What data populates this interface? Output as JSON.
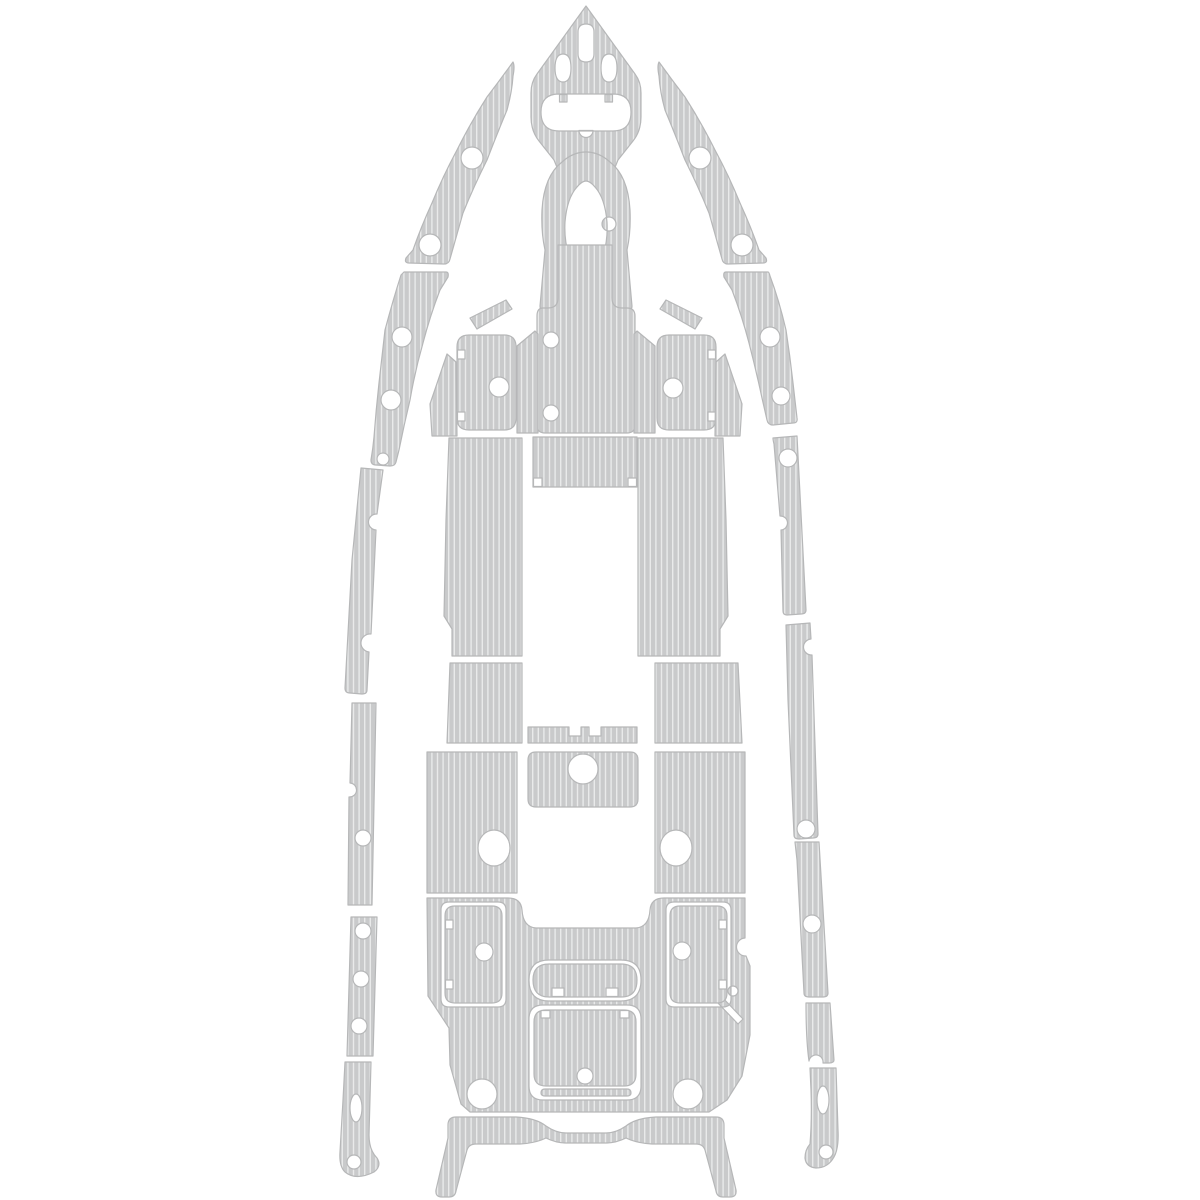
{
  "canvas": {
    "width": 1200,
    "height": 1200
  },
  "palette": {
    "background": "#ffffff",
    "pad_fill": "#c9cacb",
    "pad_stripe": "#e9eaea",
    "pad_outline": "#b6b7b8"
  },
  "pattern": {
    "orientation": "vertical",
    "stripe_pitch_px": 5.6,
    "stripe_width_px": 1.4
  },
  "pieces": [
    {
      "name": "bow-cap-pad",
      "d": "M586,6 L635,74 Q641,82 641,93 L641,117 Q641,131 633,141 L618,160 L611,177 Q598,168 586,168 Q574,168 561,177 L554,160 L539,141 Q531,131 531,117 L531,93 Q531,82 537,74 Z M586,24 Q594,24 594,32 L594,54 Q594,62 586,62 Q578,62 578,54 L578,32 Q578,24 586,24 Z M563,54 Q571,54 571,68 Q571,82 563,82 Q555,82 555,68 Q555,54 563,54 Z M609,54 Q617,54 617,68 Q617,82 609,82 Q601,82 601,68 Q601,54 609,54 Z M559,94 L613,94 Q631,94 631,112 Q631,131 613,131 L559,131 Q541,131 541,112 Q541,94 559,94 Z M559.5,94.5 L567,94.5 L567,102 L559.5,102 Z M605,94.5 L612.5,94.5 L612.5,102 L605,102 Z M579,130.5 A7,7 0 0 0 593,130.5 Z"
    },
    {
      "name": "bow-arch-pad",
      "d": "M540,306 L545,250 Q541,232 542,210 Q544,176 562,162 Q573,152 586,152 Q599,152 610,162 Q628,176 630,210 Q631,232 627,250 L632,306 Q632,311 626,311 L610,311 Q605,311 605,306 L603,256 Q608,240 607,222 Q605,198 595,187 Q590,181 586,181 Q582,181 577,187 Q567,198 565,222 Q564,240 569,256 L567,306 Q567,311 562,311 L546,311 Q540,311 540,306 Z M602,224 A7,7 0 1 0 616,224 A7,7 0 1 0 602,224 Z"
    },
    {
      "name": "console-front-pad",
      "d": "M558,245 L612,245 L612,298 Q612,308 622,308 L627,308 Q635,308 635,316 L635,425 Q635,433 627,433 L545,433 Q537,433 537,425 L537,316 Q537,308 543,308 L548,308 Q558,308 558,298 Z M543,340 A8,8 0 1 0 559,340 A8,8 0 1 0 543,340 Z M543,413 A8,8 0 1 0 559,413 A8,8 0 1 0 543,413 Z"
    },
    {
      "name": "fwd-hatch-pad-port",
      "d": "M469,335 L504,335 Q516,335 516,347 L516,418 Q516,430 504,430 L469,430 Q457,430 457,418 L457,347 Q457,335 469,335 Z M489,387 A10,10 0 1 0 509,387 A10,10 0 1 0 489,387 Z M457.5,350 L465,350 L465,359 L457.5,359 Z M457.5,412 L465,412 L465,421 L457.5,421 Z"
    },
    {
      "name": "fwd-hatch-pad-starboard",
      "d": "M669,335 L704,335 Q716,335 716,347 L716,418 Q716,430 704,430 L669,430 Q657,430 657,418 L657,347 Q657,335 669,335 Z M663,388 A10,10 0 1 0 683,388 A10,10 0 1 0 663,388 Z M708,350 L715.5,350 L715.5,359 L708,359 Z M708,412 L715.5,412 L715.5,421 L708,421 Z"
    },
    {
      "name": "fwd-floor-strip-port",
      "d": "M517,346 L535,331 L538,334 L538,433 L517,433 Z"
    },
    {
      "name": "fwd-floor-strip-starboard",
      "d": "M655,346 L637,331 L634,334 L634,433 L655,433 Z"
    },
    {
      "name": "bow-sliver-port",
      "d": "M470,318 L506,300 L512,309 L477,329 Z"
    },
    {
      "name": "bow-sliver-starboard",
      "d": "M702,318 L666,300 L660,309 L695,329 Z"
    },
    {
      "name": "bow-wedge-port",
      "d": "M432,436 L430,404 L447,354 L456,362 L457,436 Z"
    },
    {
      "name": "bow-wedge-starboard",
      "d": "M740,436 L742,404 L725,354 L716,362 L715,436 Z"
    },
    {
      "name": "cockpit-floor-port",
      "d": "M449,438 L522,438 L522,656 L452,656 L452,629 L444,616 L446,520 Z"
    },
    {
      "name": "cockpit-floor-starboard",
      "d": "M638,438 L723,438 L726,520 L728,616 L720,629 L720,656 L638,656 Z"
    },
    {
      "name": "cockpit-floor-center",
      "d": "M533,437 L637,437 L637,487 L533,487 Z M533.5,478 L542,478 L542,486.5 L533.5,486.5 Z M628,478 L636.5,478 L636.5,486.5 L628,486.5 Z"
    },
    {
      "name": "mid-floor-port",
      "d": "M450,663 L522,663 L522,743 L447,743 Z"
    },
    {
      "name": "mid-floor-starboard",
      "d": "M655,663 L738,663 L742,743 L655,743 Z"
    },
    {
      "name": "step-pad",
      "d": "M528,727 L569,727 L569,736 L581,736 L581,727 L589,727 L589,736 L601,736 L601,727 L637,727 L637,743 L528,743 Z"
    },
    {
      "name": "leaning-post-pad",
      "d": "M536,752 L630,752 Q638,752 638,760 L638,799 Q638,807 630,807 L536,807 Q528,807 528,799 L528,760 Q528,752 536,752 Z M568,769 A15,15 0 1 0 598,769 A15,15 0 1 0 568,769 Z"
    },
    {
      "name": "aft-floor-port",
      "d": "M427,752 L517,752 L517,893 L427,893 Z M478,848 A16,18 0 1 0 510,848 A16,18 0 1 0 478,848 Z"
    },
    {
      "name": "aft-floor-starboard",
      "d": "M655,752 L745,752 L745,893 L655,893 Z M660,848 A16,18 0 1 0 692,848 A16,18 0 1 0 660,848 Z"
    },
    {
      "name": "aft-deck-main",
      "d": "M427,898 L508,898 Q521,898 522,910 Q523,927 536,928 L636,928 Q649,927 650,910 Q651,898 664,898 L745,898 L745,938 A9,9 0 0 0 746,956 L750,966 L750,1035 L742,1076 L727,1100 L709,1112 L470,1112 L461,1104 L450,1065 L449,1028 L428,996 Z M449,902 L498,902 Q506,902 506,910 L506,999 Q506,1007 498,1007 L449,1007 Q441,1007 441,999 L441,910 Q441,902 449,902 Z M674,902 L723,902 Q731,902 731,910 L731,999 Q731,1007 723,1007 L674,1007 Q666,1007 666,999 L666,910 Q666,902 674,902 Z M549,960 L621,960 Q641,960 641,980 Q641,1001 621,1001 L549,1001 Q529,1001 529,980 Q529,960 549,960 Z M543,1005 L627,1005 Q641,1005 641,1019 L641,1086 Q641,1100 627,1100 L543,1100 Q529,1100 529,1086 L529,1019 Q529,1005 543,1005 Z M467,1094 A15,15 0 1 0 497,1094 A15,15 0 1 0 467,1094 Z M673,1094 A15,15 0 1 0 703,1094 A15,15 0 1 0 673,1094 Z M728,991 A5,5 0 1 0 738,991 A5,5 0 1 0 728,991 Z M716,1001 L738,1024 L743,1019 L721,996 Z"
    },
    {
      "name": "aft-hatch-pad-port",
      "d": "M455,906 L492,906 Q502,906 502,916 L502,993 Q502,1003 492,1003 L455,1003 Q445,1003 445,993 L445,916 Q445,906 455,906 Z M475,952 A9,9 0 1 0 493,952 A9,9 0 1 0 475,952 Z M445.5,920 L453,920 L453,929 L445.5,929 Z M445.5,980 L453,980 L453,989 L445.5,989 Z"
    },
    {
      "name": "aft-hatch-pad-starboard",
      "d": "M680,906 L717,906 Q727,906 727,916 L727,993 Q727,1003 717,1003 L680,1003 Q670,1003 670,993 L670,916 Q670,906 680,906 Z M673,951 A9,9 0 1 0 691,951 A9,9 0 1 0 673,951 Z M719,920 L726.5,920 L726.5,929 L719,929 Z M719,980 L726.5,980 L726.5,989 L719,989 Z"
    },
    {
      "name": "aft-pill-pad",
      "d": "M549,964 L621,964 Q637,964 637,980 Q637,997 621,997 L549,997 Q533,997 533,980 Q533,964 549,964 Z M552,988 L564,988 L564,996.5 L552,996.5 Z M606,988 L618,988 L618,996.5 L606,996.5 Z"
    },
    {
      "name": "aft-square-hatch-pad",
      "d": "M546,1010 L624,1010 Q636,1010 636,1022 L636,1074 Q636,1086 624,1086 L546,1086 Q534,1086 534,1074 L534,1022 Q534,1010 546,1010 Z M577,1076 A8,8 0 1 0 593,1076 A8,8 0 1 0 577,1076 Z M541,1010.5 L550,1010.5 L550,1018 L541,1018 Z M620,1010.5 L629,1010.5 L629,1018 L620,1018 Z"
    },
    {
      "name": "aft-threshold-strip",
      "d": "M545,1089 L627,1089 Q631,1089 631,1093 Q631,1096 627,1096 L545,1096 Q541,1096 541,1093 Q541,1089 545,1089 Z"
    },
    {
      "name": "transom-u-pad",
      "d": "M448,1125 Q448,1117 456,1117 L516,1117 Q536,1118 546,1126 Q556,1133 566,1133 L606,1133 Q616,1133 626,1126 Q636,1118 656,1117 L716,1117 Q724,1117 724,1125 L724,1138 L736,1190 Q737,1197 730,1197 L723,1197 Q717,1197 716,1191 L705,1150 Q703,1144 696,1144 L652,1144 Q636,1143 626,1138 Q616,1143 606,1143 L566,1143 Q556,1143 546,1138 Q536,1143 520,1144 L476,1144 Q469,1144 467,1150 L456,1191 Q455,1197 449,1197 L442,1197 Q435,1197 436,1190 L448,1138 Z"
    },
    {
      "name": "sheer-crescent-upper-port",
      "d": "M513,62 Q500,80 487,97 Q471,122 457,150 Q443,176 432,203 Q421,227 413,250 L406,258 Q404,263 409,263 L444,264 Q449,264 450,259 L463,213 Q474,186 487,160 Q497,134 507,110 Q512,92 513,76 Q515,66 513,62 Z M461,158 A11,11 0 1 0 483,158 A11,11 0 1 0 461,158 Z M419,245 A11,11 0 1 0 441,245 A11,11 0 1 0 419,245 Z"
    },
    {
      "name": "sheer-crescent-lower-port",
      "d": "M404,272 L446,272 Q449,272 448,277 L440,290 Q430,316 423,343 Q415,371 410,400 Q404,425 399,450 L396,462 Q395,466 390,466 L376,465 Q371,465 371,460 Q373,448 374,437 Q376,410 379,383 Q382,356 385,330 Q393,300 401,275 Z M392,337 A10,10 0 1 0 412,337 A10,10 0 1 0 392,337 Z M381,400 A10,10 0 1 0 401,400 A10,10 0 1 0 381,400 Z M377,459 A6,6 0 1 0 389,459 A6,6 0 1 0 377,459 Z"
    },
    {
      "name": "rail-port-1",
      "d": "M361,468 L383,470 L377,514 A7,7 0 0 0 376,530 L371,634 A8,8 0 0 0 369,652 L367,690 Q367,694 362,694 L350,693 Q345,693 345,688 L352,560 Z"
    },
    {
      "name": "rail-port-2",
      "d": "M352,703 L376,703 L372,905 L348,905 L349,797 A7,7 0 0 0 350,783 Z M355,838 A8,8 0 1 0 371,838 A8,8 0 1 0 355,838 Z"
    },
    {
      "name": "rail-port-3",
      "d": "M351,917 L377,917 L373,1056 L347,1056 Z M355,931 A8,8 0 1 0 371,931 A8,8 0 1 0 355,931 Z M353,979 A8,8 0 1 0 369,979 A8,8 0 1 0 353,979 Z M351,1026 A8,8 0 1 0 367,1026 A8,8 0 1 0 351,1026 Z"
    },
    {
      "name": "rail-port-4",
      "d": "M345,1062 L371,1062 L369,1135 Q369,1150 377,1158 Q382,1166 374,1172 Q356,1181 345,1172 Q339,1166 340,1152 L343,1100 Z M350,1108 A6,14 0 1 0 362,1108 A6,14 0 1 0 350,1108 Z M347,1162 A7,7 0 1 0 361,1162 A7,7 0 1 0 347,1162 Z"
    },
    {
      "name": "sheer-crescent-upper-starboard",
      "d": "M659,62 Q672,80 685,97 Q701,122 715,150 Q729,176 740,203 Q751,227 759,250 L766,258 Q768,263 763,263 L728,264 Q723,264 722,259 L709,213 Q698,186 685,160 Q675,134 665,110 Q660,92 659,76 Q657,66 659,62 Z M689,158 A11,11 0 1 0 711,158 A11,11 0 1 0 689,158 Z M731,245 A11,11 0 1 0 753,245 A11,11 0 1 0 731,245 Z"
    },
    {
      "name": "sheer-crescent-lower-starboard",
      "d": "M768,272 L726,272 Q723,272 724,277 L732,290 Q742,316 749,343 Q756,370 762,398 L767,420 Q768,425 773,425 L793,423 Q798,423 797,418 L793,383 Q790,356 786,330 Q779,300 770,276 Q769,272 768,272 Z M760,337 A10,10 0 1 0 780,337 A10,10 0 1 0 760,337 Z M772,396 A9,9 0 1 0 790,396 A9,9 0 1 0 772,396 Z"
    },
    {
      "name": "rail-starboard-1",
      "d": "M773,438 L797,436 L806,610 Q806,614 801,614 L787,615 Q783,615 783,611 L781,530 A7,7 0 0 0 780,516 L774,444 Q773,440 773,438 Z M779,458 A9,9 0 1 0 797,458 A9,9 0 1 0 779,458 Z"
    },
    {
      "name": "rail-starboard-2",
      "d": "M786,625 L810,623 L811,639 A8,8 0 0 0 812,655 L818,834 Q818,838 813,838 L799,839 Q794,839 794,835 L788,700 Z M797,829 A9,9 0 1 0 815,829 A9,9 0 1 0 797,829 Z"
    },
    {
      "name": "rail-starboard-3",
      "d": "M795,842 L819,842 L828,993 Q828,997 823,997 L809,997 Q804,997 804,993 L797,860 Z M803,924 A9,9 0 1 0 821,924 A9,9 0 1 0 803,924 Z"
    },
    {
      "name": "rail-starboard-4",
      "d": "M806,1003 L830,1003 L834,1060 Q834,1063 829,1063 L823,1063 A7,7 0 0 0 809,1061 Q806,1040 806,1003 Z"
    },
    {
      "name": "rail-starboard-5",
      "d": "M810,1068 L836,1068 L838,1130 Q839,1148 834,1157 Q828,1168 816,1168 Q806,1167 805,1158 Q805,1150 810,1144 Q812,1120 811,1090 Z M817,1100 A6,14 0 1 0 829,1100 A6,14 0 1 0 817,1100 Z M819,1152 A7,7 0 1 0 833,1152 A7,7 0 1 0 819,1152 Z"
    }
  ]
}
